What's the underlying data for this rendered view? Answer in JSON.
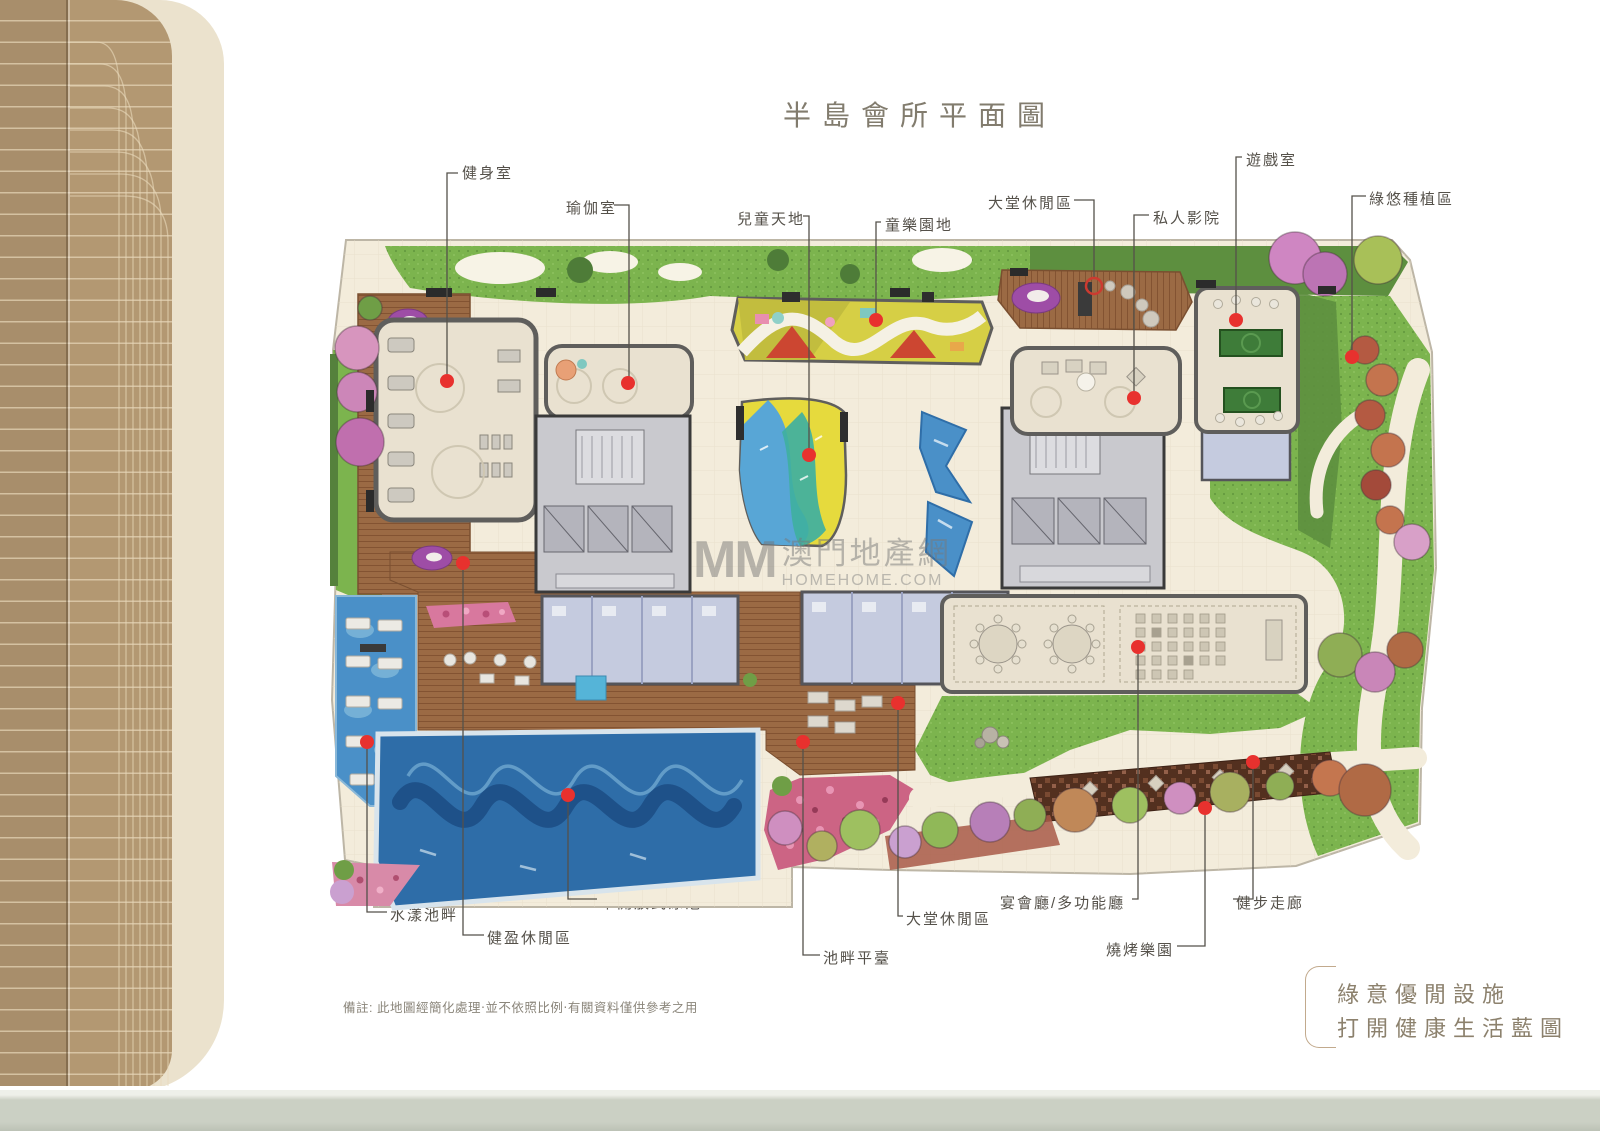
{
  "page": {
    "title": "半島會所平面圖",
    "note": "備註: 此地圖經簡化處理‧並不依照比例‧有關資料僅供參考之用",
    "slogan_line1": "綠意優閒設施",
    "slogan_line2": "打開健康生活藍圖"
  },
  "watermark": {
    "logo": "MM",
    "name": "澳門地產網",
    "domain": "HOMEHOME.COM"
  },
  "labels": {
    "gym": "健身室",
    "yoga": "瑜伽室",
    "kids_world": "兒童天地",
    "kids_playground": "童樂園地",
    "lobby_lounge_top": "大堂休閒區",
    "private_cinema": "私人影院",
    "game_room": "遊戲室",
    "green_planting": "綠悠種植區",
    "water_poolside": "水漾池畔",
    "fit_leisure": "健盈休閒區",
    "semi_open_pool": "半開放式泳池",
    "poolside_deck": "池畔平臺",
    "lobby_lounge_bottom": "大堂休閒區",
    "banquet_hall": "宴會廳/多功能廳",
    "bbq_garden": "燒烤樂園",
    "walking_corridor": "健步走廊"
  },
  "colors": {
    "marker_red": "#e8312e",
    "lawn_green": "#7cb44e",
    "hedge_green": "#5d8f3f",
    "pool_blue": "#2e6da8",
    "deck_brown": "#9b6a44",
    "tile_cream": "#f3ecdb",
    "spine_tan": "#b39872",
    "title_text": "#827c6e",
    "label_text": "#55514a"
  }
}
